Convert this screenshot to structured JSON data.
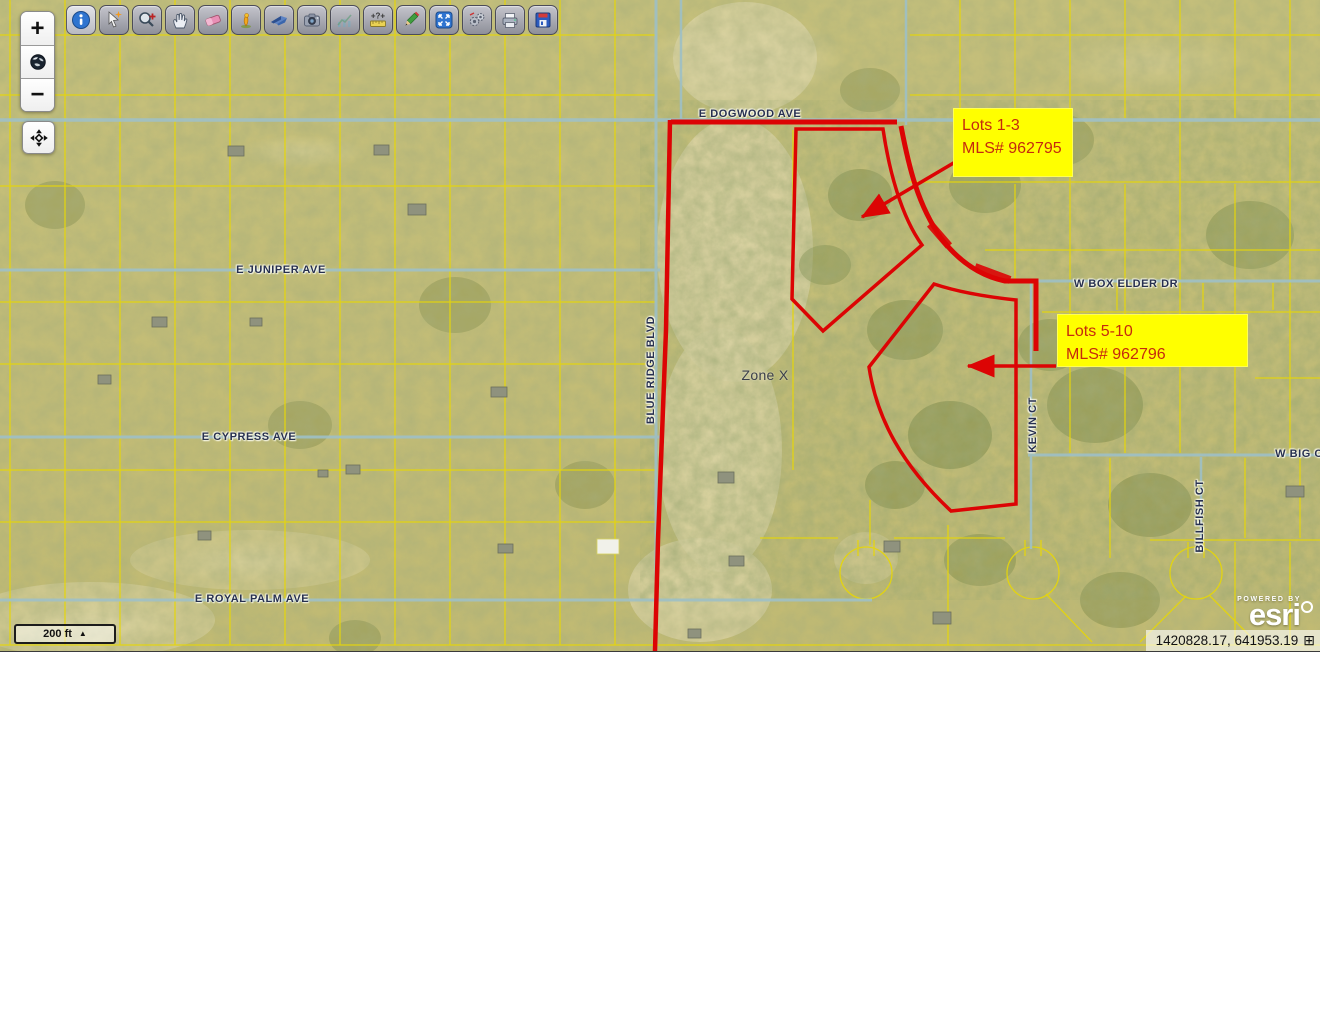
{
  "toolbar": {
    "buttons": [
      {
        "name": "info-tool",
        "active": true
      },
      {
        "name": "select-tool"
      },
      {
        "name": "zoom-magnifier-tool"
      },
      {
        "name": "pan-hand-tool"
      },
      {
        "name": "eraser-tool"
      },
      {
        "name": "marker-bird-tool"
      },
      {
        "name": "fly-navigate-tool"
      },
      {
        "name": "camera-tool"
      },
      {
        "name": "chart-tool",
        "disabled": true
      },
      {
        "name": "measure-tool"
      },
      {
        "name": "draw-pencil-tool"
      },
      {
        "name": "extent-tool"
      },
      {
        "name": "settings-gears-tool"
      },
      {
        "name": "print-tool"
      },
      {
        "name": "save-tool"
      }
    ]
  },
  "zoom_controls": {
    "zoom_in": "+",
    "zoom_out": "−"
  },
  "map": {
    "streets": [
      {
        "label": "E DOGWOOD AVE"
      },
      {
        "label": "E JUNIPER AVE"
      },
      {
        "label": "E CYPRESS AVE"
      },
      {
        "label": "E ROYAL PALM AVE"
      },
      {
        "label": "W BOX ELDER DR"
      },
      {
        "label": "W BIG C"
      },
      {
        "label": "BLUE RIDGE BLVD"
      },
      {
        "label": "KEVIN CT"
      },
      {
        "label": "BILLFISH CT"
      }
    ],
    "zone_label": "Zone X",
    "annotations": [
      {
        "line1": "Lots 1-3",
        "line2": "MLS# 962795"
      },
      {
        "line1": "Lots 5-10",
        "line2": "MLS# 962796"
      }
    ],
    "scale_bar": {
      "label": "200 ft",
      "arrow": "▲"
    },
    "coordinates": {
      "value": "1420828.17, 641953.19",
      "grid_icon": "⊞"
    },
    "attribution": {
      "powered_by": "POWERED BY",
      "brand": "esri"
    }
  },
  "colors": {
    "lot_outline_red": "#dc0404",
    "annotation_bg": "#ffff00",
    "annotation_text": "#c52a0e",
    "parcel_line_yellow": "#e6d60a",
    "road_blue": "#9ec0c6"
  }
}
